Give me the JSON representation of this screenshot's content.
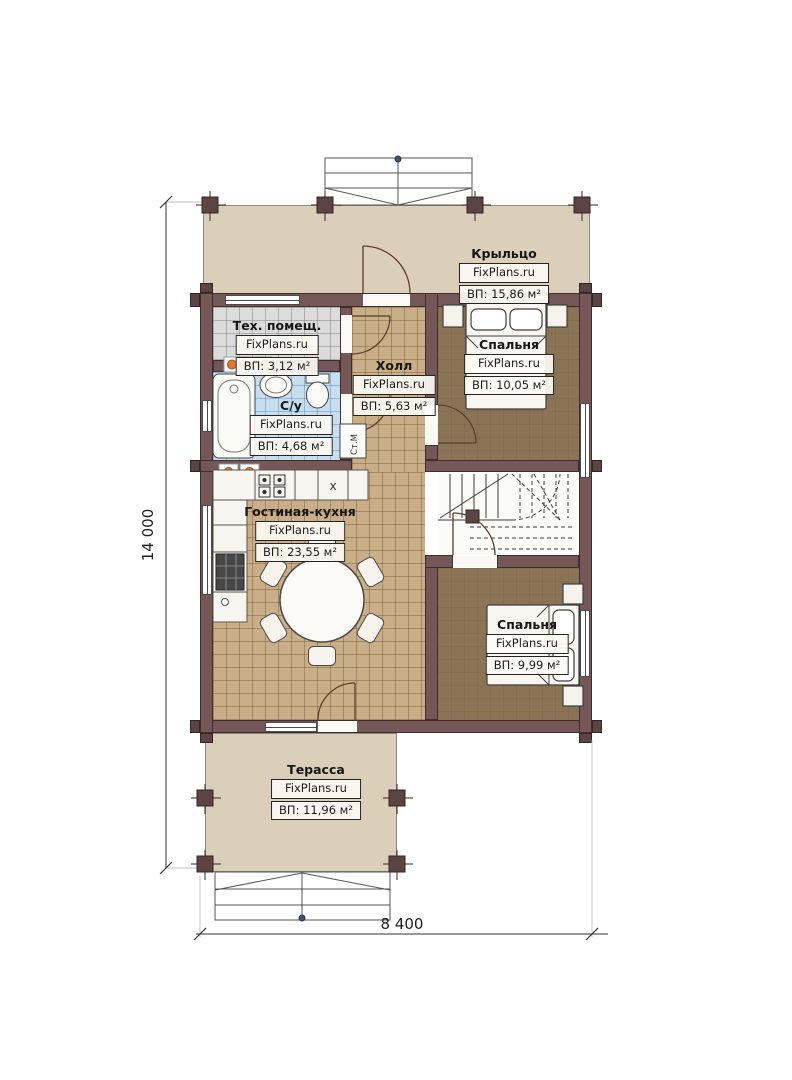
{
  "plan": {
    "dimensions": {
      "height_label": "14 000",
      "width_label": "8 400"
    },
    "rooms": [
      {
        "key": "porch",
        "name": "Крыльцо",
        "brand": "FixPlans.ru",
        "area": "ВП: 15,86 м²"
      },
      {
        "key": "tech-room",
        "name": "Тех. помещ.",
        "brand": "FixPlans.ru",
        "area": "ВП: 3,12 м²"
      },
      {
        "key": "hall",
        "name": "Холл",
        "brand": "FixPlans.ru",
        "area": "ВП: 5,63 м²"
      },
      {
        "key": "bedroom-top",
        "name": "Спальня",
        "brand": "FixPlans.ru",
        "area": "ВП: 10,05 м²"
      },
      {
        "key": "bathroom",
        "name": "С/у",
        "brand": "FixPlans.ru",
        "area": "ВП: 4,68 м²"
      },
      {
        "key": "living-kitchen",
        "name": "Гостиная-кухня",
        "brand": "FixPlans.ru",
        "area": "ВП: 23,55 м²"
      },
      {
        "key": "bedroom-bottom",
        "name": "Спальня",
        "brand": "FixPlans.ru",
        "area": "ВП: 9,99 м²"
      },
      {
        "key": "terrace",
        "name": "Терасса",
        "brand": "FixPlans.ru",
        "area": "ВП: 11,96 м²"
      }
    ],
    "appliances": {
      "washing_machine": "Ст.М",
      "sink_mark": "x"
    },
    "colors": {
      "wall": "#755757",
      "floor_wood": "#c9ae87",
      "floor_tile_gray": "#dbdbdb",
      "floor_tile_blue": "#c6def0",
      "floor_bedroom": "#8b7456",
      "outdoor_slab": "#dbcfba",
      "radiator": "#e0762f"
    }
  }
}
